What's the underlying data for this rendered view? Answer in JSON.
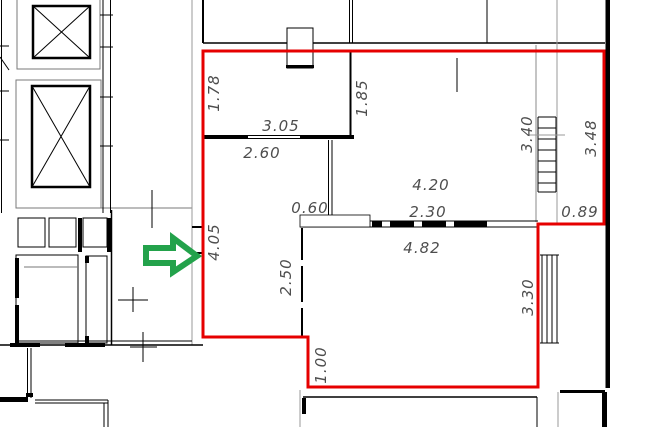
{
  "drawing": {
    "title": "apartment-floor-plan",
    "colors": {
      "highlight_outline": "#e60000",
      "pointer_arrow": "#23a24b",
      "walls": "#000000",
      "secondary_lines": "#8a8a8a",
      "label_text": "#4d4d4d",
      "background": "#ffffff"
    },
    "dimension_labels": [
      {
        "value": "1.78",
        "orientation": "vertical",
        "x": 214,
        "y": 93
      },
      {
        "value": "3.05",
        "orientation": "horizontal",
        "x": 281,
        "y": 126
      },
      {
        "value": "2.60",
        "orientation": "horizontal",
        "x": 262,
        "y": 153
      },
      {
        "value": "1.85",
        "orientation": "vertical",
        "x": 362,
        "y": 98
      },
      {
        "value": "3.40",
        "orientation": "vertical",
        "x": 527,
        "y": 134
      },
      {
        "value": "3.48",
        "orientation": "vertical",
        "x": 591,
        "y": 138
      },
      {
        "value": "4.20",
        "orientation": "horizontal",
        "x": 431,
        "y": 185
      },
      {
        "value": "2.30",
        "orientation": "horizontal",
        "x": 428,
        "y": 212
      },
      {
        "value": "0.60",
        "orientation": "horizontal",
        "x": 310,
        "y": 208
      },
      {
        "value": "0.89",
        "orientation": "horizontal",
        "x": 580,
        "y": 212
      },
      {
        "value": "4.82",
        "orientation": "horizontal",
        "x": 422,
        "y": 248
      },
      {
        "value": "2.50",
        "orientation": "vertical",
        "x": 286,
        "y": 277
      },
      {
        "value": "4.05",
        "orientation": "vertical",
        "x": 214,
        "y": 242
      },
      {
        "value": "3.30",
        "orientation": "vertical",
        "x": 528,
        "y": 297
      },
      {
        "value": "1.00",
        "orientation": "vertical",
        "x": 321,
        "y": 365
      }
    ]
  }
}
